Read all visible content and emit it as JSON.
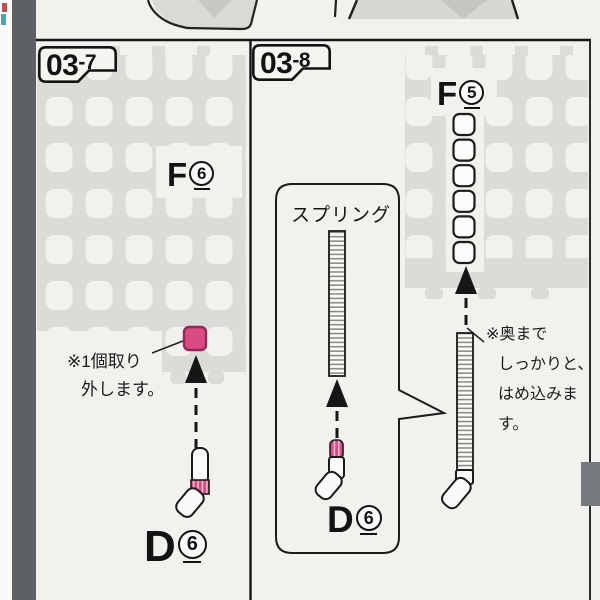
{
  "meta": {
    "description": "Scanned plastic-model assembly manual page, steps 03-7 and 03-8"
  },
  "colors": {
    "paper": "#f2f1ee",
    "ink": "#161616",
    "runner_gray": "#dcdbd7",
    "spine_gray": "#5d6165",
    "highlight_pink_fill": "#d84b84",
    "highlight_pink_border": "#97275a",
    "edge_tab_gray": "#75797c"
  },
  "step_left": {
    "badge_main": "03",
    "badge_sub": "-7",
    "runner_letter": "F",
    "runner_number": "6",
    "note_line1": "※1個取り",
    "note_line2": "外します。",
    "part_letter": "D",
    "part_number": "6"
  },
  "step_right": {
    "badge_main": "03",
    "badge_sub": "-8",
    "spring_label": "スプリング",
    "runner_letter": "F",
    "runner_number": "5",
    "note_line1": "※奥まで",
    "note_line2": "しっかりと、",
    "note_line3": "はめ込みます。",
    "part_letter": "D",
    "part_number": "6"
  }
}
